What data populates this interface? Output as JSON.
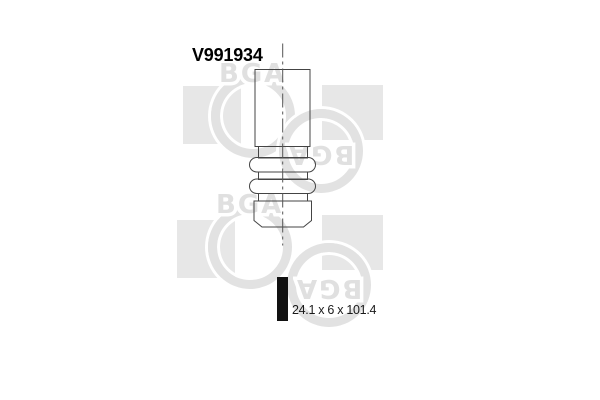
{
  "product": {
    "part_number": "V991934",
    "dimensions": "24.1 x 6 x 101.4"
  },
  "watermark": {
    "logo_text": "BGA"
  },
  "colors": {
    "drawing_line": "#444444",
    "watermark_gray": "#e2e2e2",
    "square_gray": "#e7e7e7",
    "bar_black": "#111111",
    "background": "#ffffff"
  }
}
